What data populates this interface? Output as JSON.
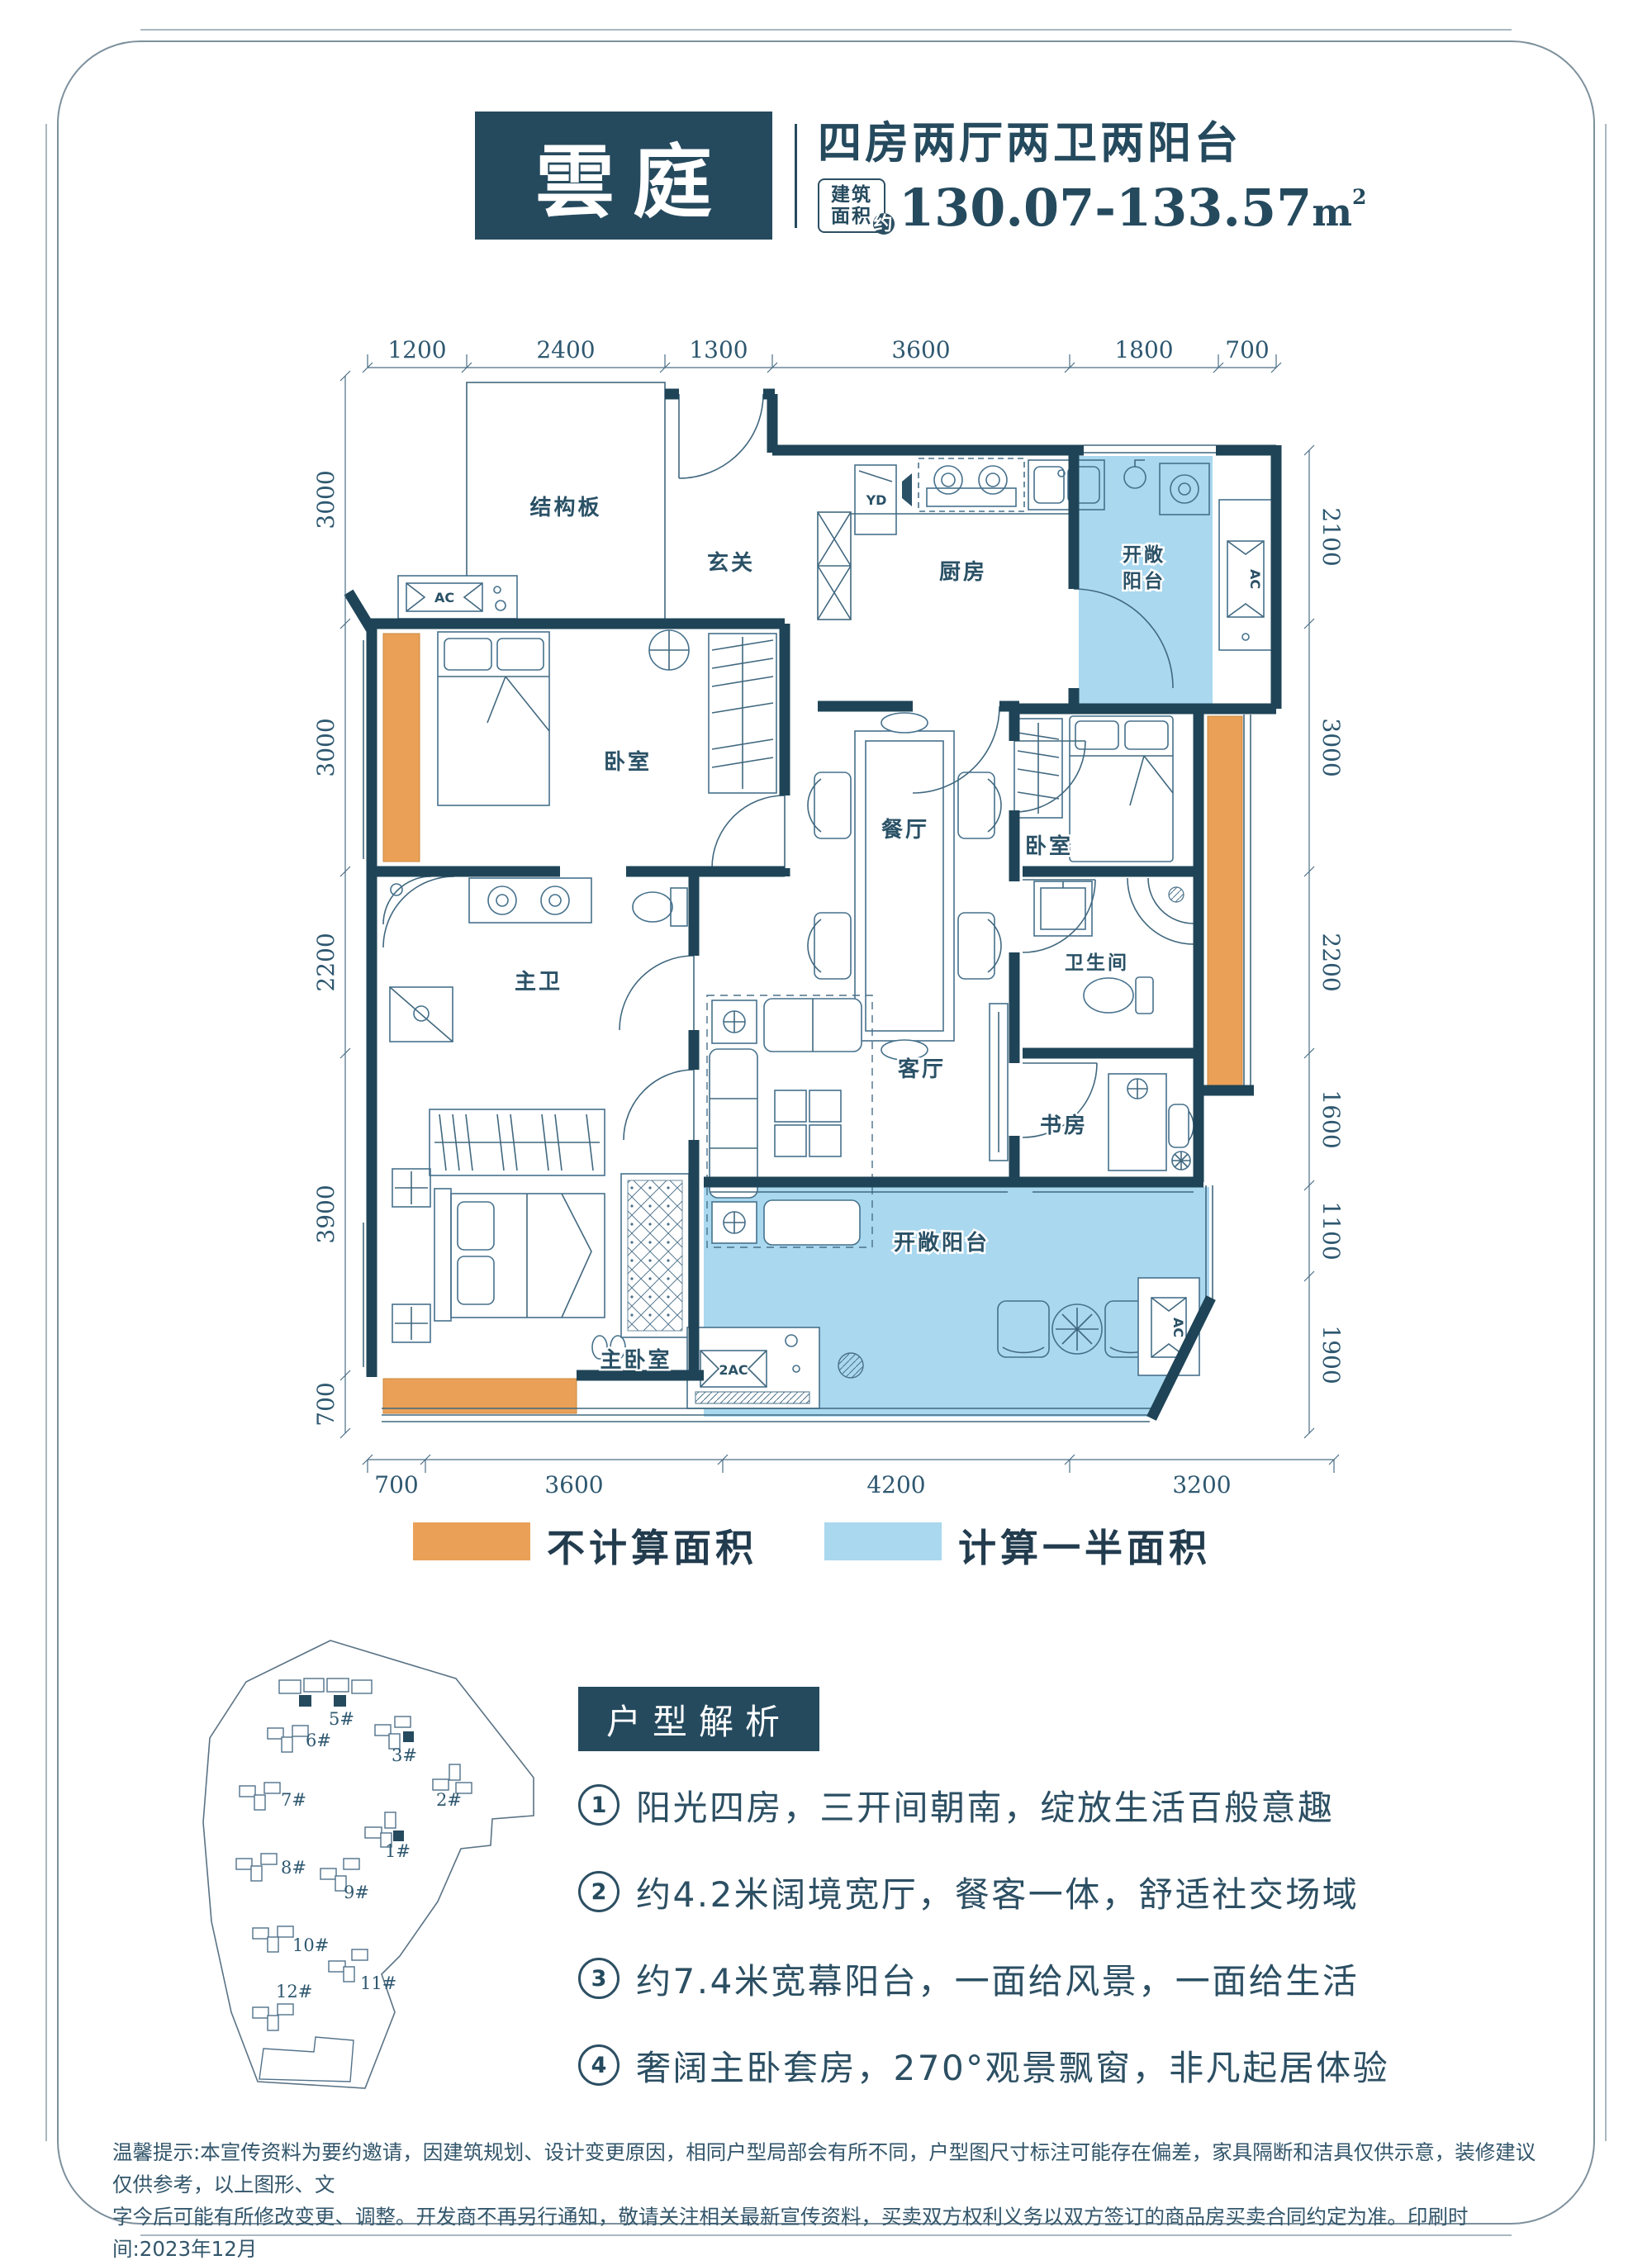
{
  "colors": {
    "primary_dark": "#254a5e",
    "wall": "#1f4457",
    "orange_not_counted": "#eaa157",
    "blue_half_counted": "#a9d8ef",
    "line": "#41687f"
  },
  "title_block": {
    "name": "雲庭",
    "subtitle": "四房两厅两卫两阳台",
    "area_badge": {
      "line1": "建筑",
      "line2": "面积",
      "approx": "约"
    },
    "area_value": "130.07-133.57",
    "area_unit_base": "m",
    "area_unit_sup": "2"
  },
  "floor_plan": {
    "rooms": {
      "structural_slab": "结构板",
      "entry": "玄关",
      "kitchen": "厨房",
      "balcony_top_line1": "开敞",
      "balcony_top_line2": "阳台",
      "dining": "餐厅",
      "bedroom_left": "卧室",
      "bedroom_right": "卧室",
      "master_bath": "主卫",
      "bath": "卫生间",
      "living": "客厅",
      "study": "书房",
      "master_bedroom": "主卧室",
      "balcony_bottom": "开敞阳台"
    },
    "equipment": {
      "ac": "AC",
      "ac2": "2AC",
      "yd": "YD"
    },
    "dims_top": [
      "1200",
      "2400",
      "1300",
      "3600",
      "1800",
      "700"
    ],
    "dims_left": [
      "3000",
      "3000",
      "2200",
      "3900",
      "700"
    ],
    "dims_right": [
      "2100",
      "3000",
      "2200",
      "1600",
      "1100",
      "1900"
    ],
    "dims_bottom": [
      "700",
      "3600",
      "4200",
      "3200"
    ]
  },
  "legend": {
    "items": [
      {
        "color": "#eaa157",
        "label": "不计算面积"
      },
      {
        "color": "#a9d8ef",
        "label": "计算一半面积"
      }
    ]
  },
  "site_plan": {
    "buildings": [
      {
        "id": "5#",
        "highlight": true
      },
      {
        "id": "6#",
        "highlight": false
      },
      {
        "id": "3#",
        "highlight": true
      },
      {
        "id": "2#",
        "highlight": false
      },
      {
        "id": "7#",
        "highlight": false
      },
      {
        "id": "1#",
        "highlight": true
      },
      {
        "id": "8#",
        "highlight": false
      },
      {
        "id": "9#",
        "highlight": false
      },
      {
        "id": "10#",
        "highlight": false
      },
      {
        "id": "11#",
        "highlight": false
      },
      {
        "id": "12#",
        "highlight": false
      }
    ]
  },
  "analysis": {
    "title": "户型解析",
    "items": [
      {
        "num": "1",
        "text": "阳光四房，三开间朝南，绽放生活百般意趣"
      },
      {
        "num": "2",
        "text": "约4.2米阔境宽厅，餐客一体，舒适社交场域"
      },
      {
        "num": "3",
        "text": "约7.4米宽幕阳台，一面给风景，一面给生活"
      },
      {
        "num": "4",
        "text": "奢阔主卧套房，270°观景飘窗，非凡起居体验"
      }
    ]
  },
  "disclaimer": {
    "line1": "温馨提示:本宣传资料为要约邀请，因建筑规划、设计变更原因，相同户型局部会有所不同，户型图尺寸标注可能存在偏差，家具隔断和洁具仅供示意，装修建议仅供参考，以上图形、文",
    "line2": "字今后可能有所修改变更、调整。开发商不再另行通知，敬请关注相关最新宣传资料，买卖双方权利义务以双方签订的商品房买卖合同约定为准。印刷时间:2023年12月"
  }
}
